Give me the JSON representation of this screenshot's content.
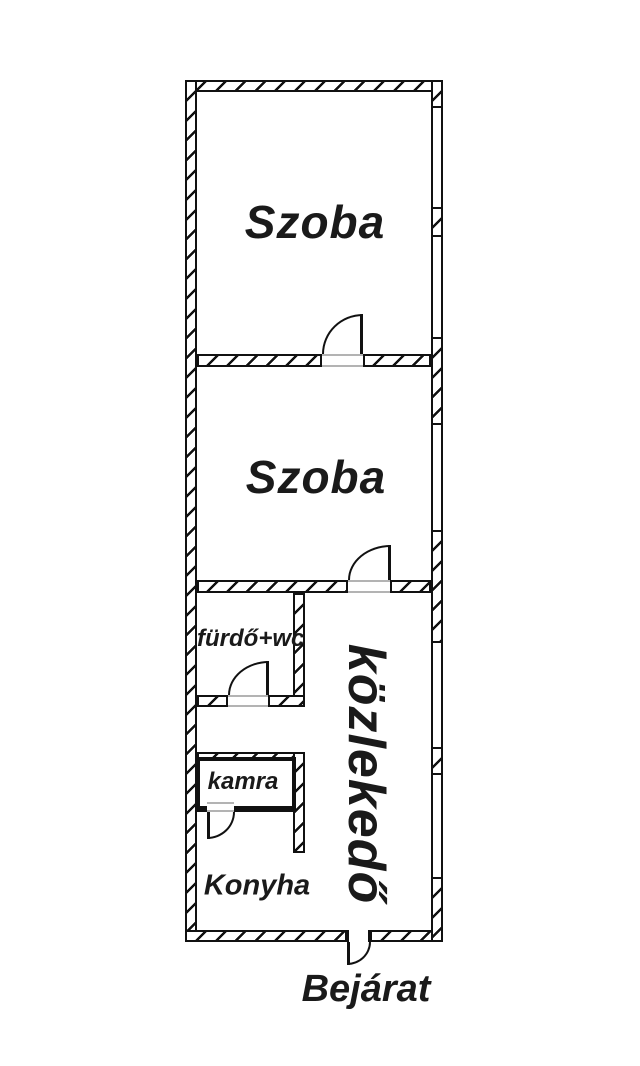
{
  "plan_title": "Apartment floor plan",
  "rooms": {
    "szoba1": {
      "label": "Szoba"
    },
    "szoba2": {
      "label": "Szoba"
    },
    "furdo": {
      "label": "fürdő+wc"
    },
    "kozlekedo": {
      "label": "közlekedő"
    },
    "kamra": {
      "label": "kamra"
    },
    "konyha": {
      "label": "Konyha"
    }
  },
  "entrance": {
    "label": "Bejárat"
  },
  "colors": {
    "line": "#111111",
    "threshold": "#b3b3b3",
    "background": "#ffffff",
    "text": "#1a1a1a"
  }
}
